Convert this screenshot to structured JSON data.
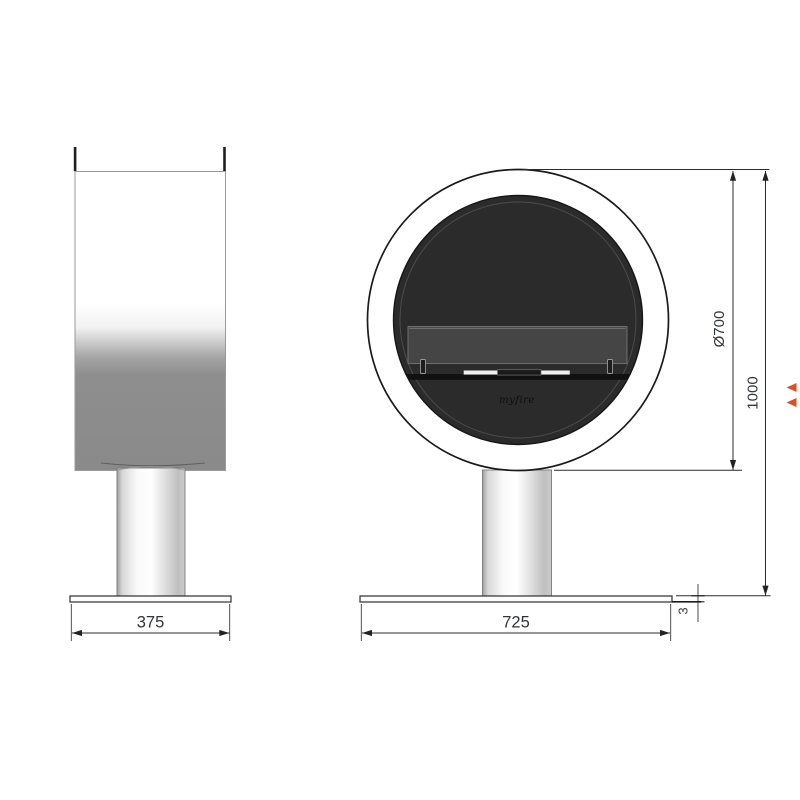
{
  "dimensions": {
    "side_base_width": "375",
    "front_base_width": "725",
    "diameter": "Ø700",
    "overall_height": "1000",
    "base_thickness": "3"
  },
  "branding": {
    "logo_text": "myfire"
  },
  "colors": {
    "background": "#ffffff",
    "outline": "#1b1b1b",
    "firebox": "#2b2b2b",
    "burner_panel": "#454545",
    "body_gray": "#8a8a8a",
    "dimension_text": "#30343c",
    "marker_accent": "#de4e26"
  }
}
